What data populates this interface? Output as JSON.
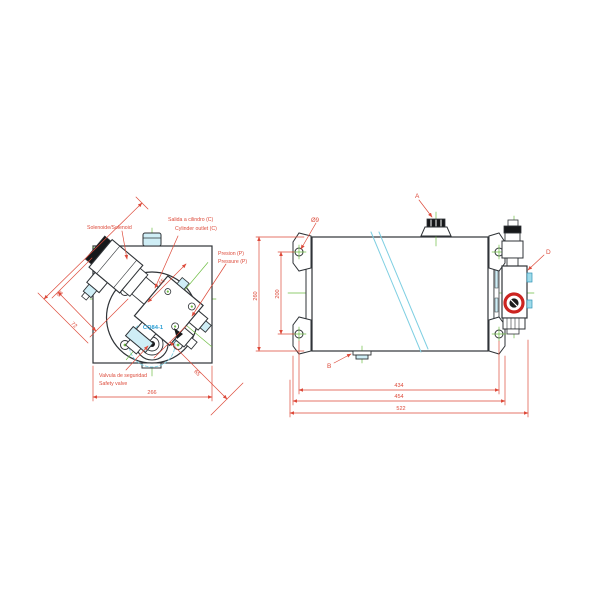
{
  "drawing": {
    "title_hint": "hydraulic power unit technical drawing",
    "colors": {
      "ink": "#2f3337",
      "red": "#dd4a3a",
      "green": "#6fbe44",
      "cyan": "#7fcfe2",
      "cyan_fill": "#cfeef6",
      "cyan_text": "#2da0d5",
      "black": "#16181a"
    },
    "left_view": {
      "labels": {
        "solenoid": "Solenoide/Solenoid",
        "cylinder_outlet_line1": "Salida a cilindro (C)",
        "cylinder_outlet_line2": "Cylinder outlet (C)",
        "pressure_line1": "Presion (P)",
        "pressure_line2": "Pressure (P)",
        "safety_valve_line1": "Valvula de seguridad",
        "safety_valve_line2": "Safety valve",
        "part_marking": "CQ84-1"
      },
      "dimensions": {
        "overall_width": "266",
        "solenoid_length": "98",
        "solenoid_offset": "72",
        "port_spacing": "65",
        "corner_offset": "65"
      }
    },
    "right_view": {
      "labels": {
        "filler_breather": "A",
        "drain_plug": "B",
        "release_valve": "D",
        "mount_hole_dia": "Ø9"
      },
      "dimensions": {
        "hole_spacing_h": "434",
        "bracket_width": "454",
        "overall_length": "522",
        "tank_height": "260",
        "hole_spacing_v": "200"
      }
    }
  }
}
